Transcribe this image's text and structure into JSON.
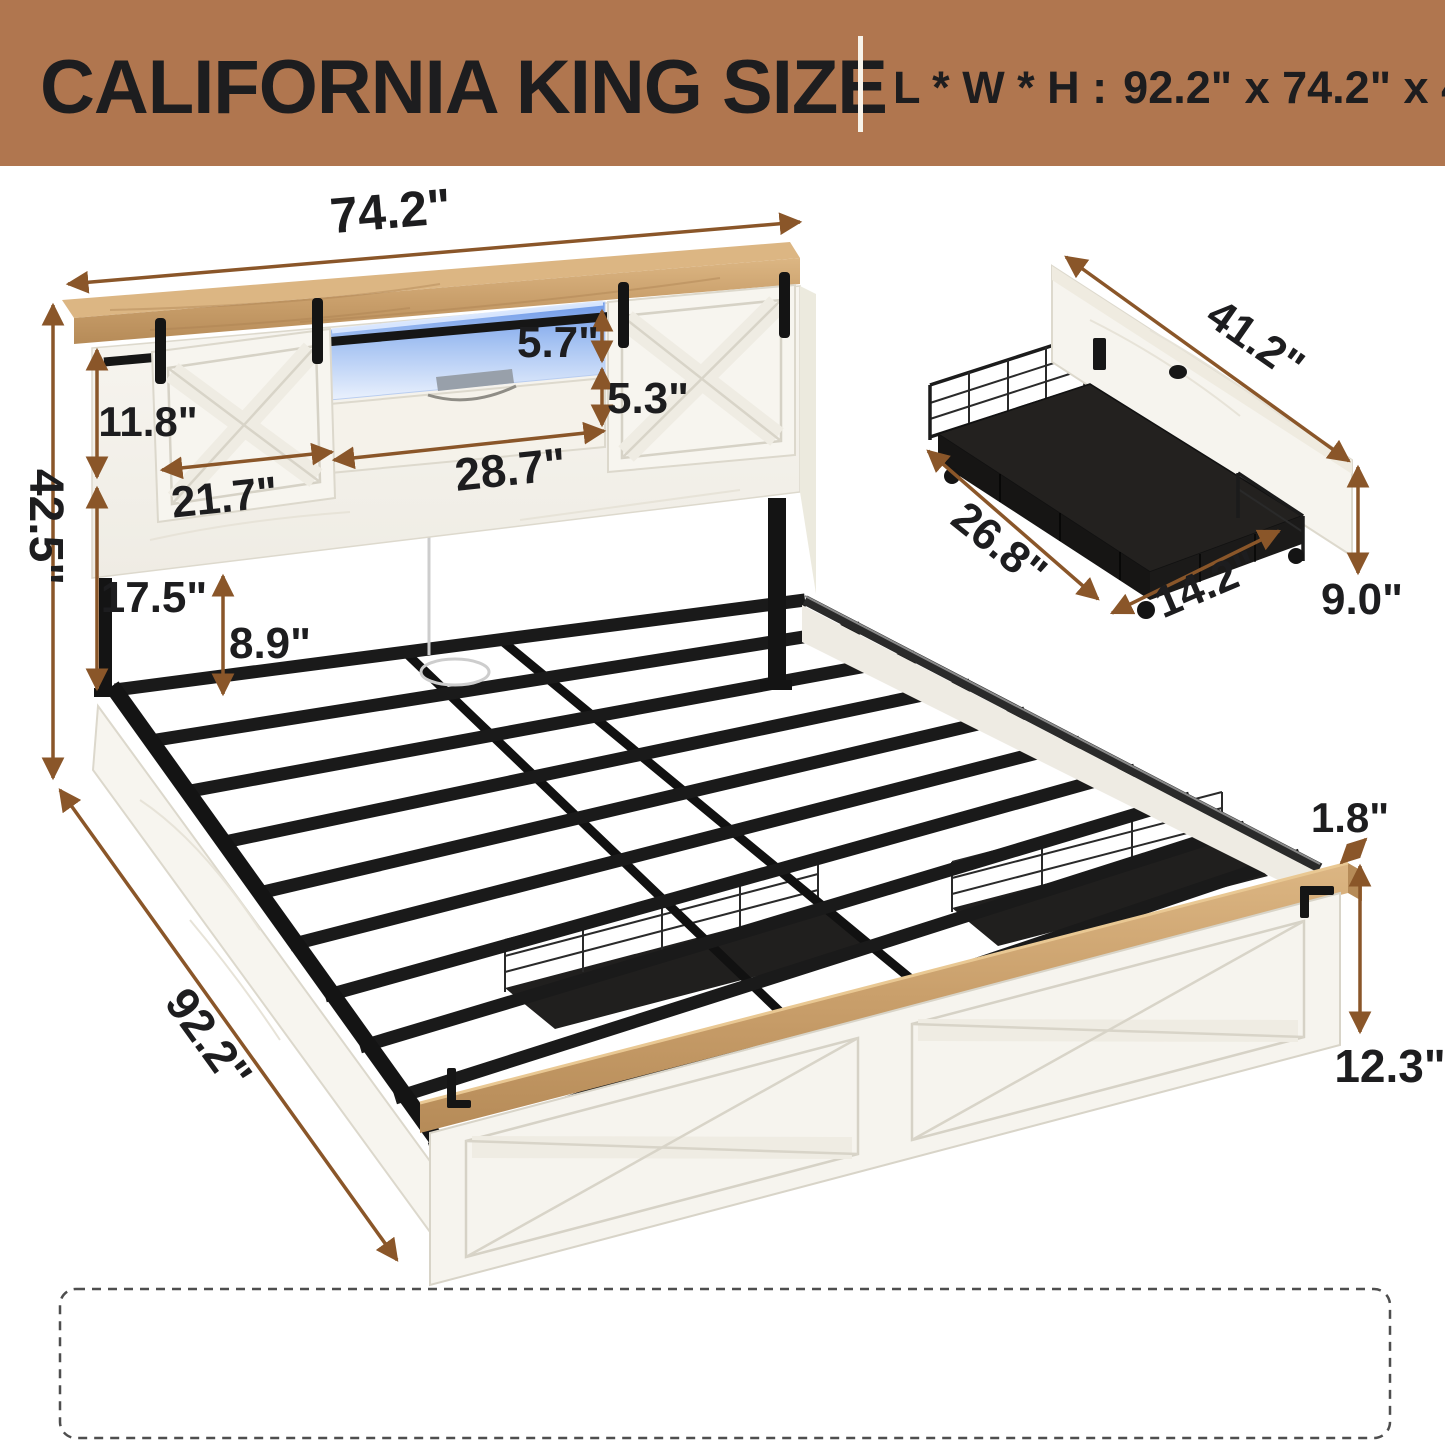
{
  "banner": {
    "title": "CALIFORNIA KING SIZE",
    "lwh_label": "L * W * H :",
    "lwh_value": "92.2\" x 74.2\" x 42.5\"",
    "bg_color": "#b0764f",
    "text_color": "#f8f3ea"
  },
  "dimensions": {
    "headboard_width": "74.2\"",
    "overall_height": "42.5\"",
    "barn_door_height": "11.8\"",
    "barn_door_width": "21.7\"",
    "shelf_opening_width": "28.7\"",
    "shelf_opening_height": "5.7\"",
    "shelf_drawer_height": "5.3\"",
    "headboard_lower_height": "17.5\"",
    "underbed_clearance": "8.9\"",
    "bed_length": "92.2\"",
    "footboard_trim_thickness": "1.8\"",
    "footboard_height": "12.3\"",
    "drawer_length": "41.2\"",
    "drawer_depth": "26.8\"",
    "drawer_width": "14.2\"",
    "drawer_height": "9.0\""
  },
  "colors": {
    "arrow": "#8a5629",
    "label": "#1d1d1f",
    "banner": "#b0764f",
    "wood": "#c9a06a",
    "metal": "#1a1a1a",
    "led": "#7da2ea",
    "white_wood": "#f6f4ee"
  }
}
